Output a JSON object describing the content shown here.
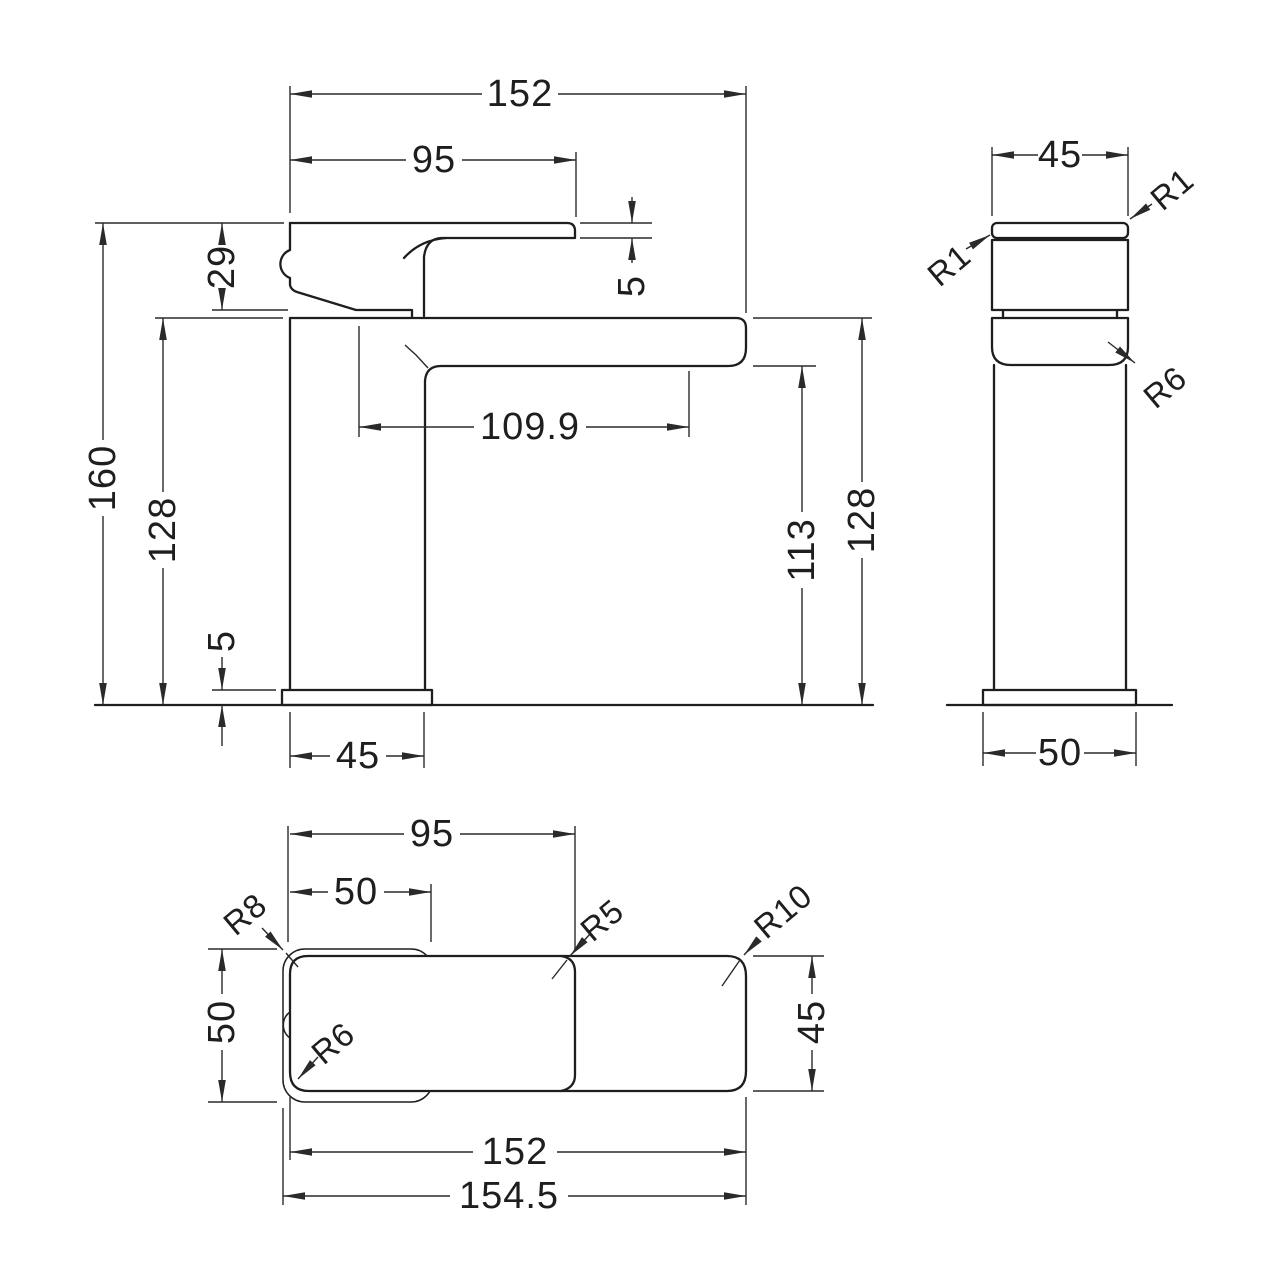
{
  "drawing_title": "basin mixer tap dimension drawing",
  "colors": {
    "background": "#ffffff",
    "line": "#1e1e1e"
  },
  "front_view": {
    "total_width": "152",
    "handle_length": "95",
    "handle_height": "29",
    "lever_tip_thickness": "5",
    "total_height": "160",
    "left_height": "128",
    "spout_reach": "109.9",
    "spout_underside_height": "113",
    "right_height": "128",
    "base_plate_thickness": "5",
    "body_width": "45"
  },
  "side_view": {
    "body_width": "45",
    "radius_top_left": "R1",
    "radius_top_right": "R1",
    "radius_spout": "R6",
    "base_plate_width": "50"
  },
  "plan_view": {
    "body_length": "95",
    "base_plate_length": "50",
    "base_plate_width": "50",
    "spout_width": "45",
    "tap_length": "152",
    "overall_length": "154.5",
    "radius_base_corner": "R8",
    "radius_body_corner": "R5",
    "radius_spout_corner": "R10",
    "radius_body_rear": "R6"
  }
}
